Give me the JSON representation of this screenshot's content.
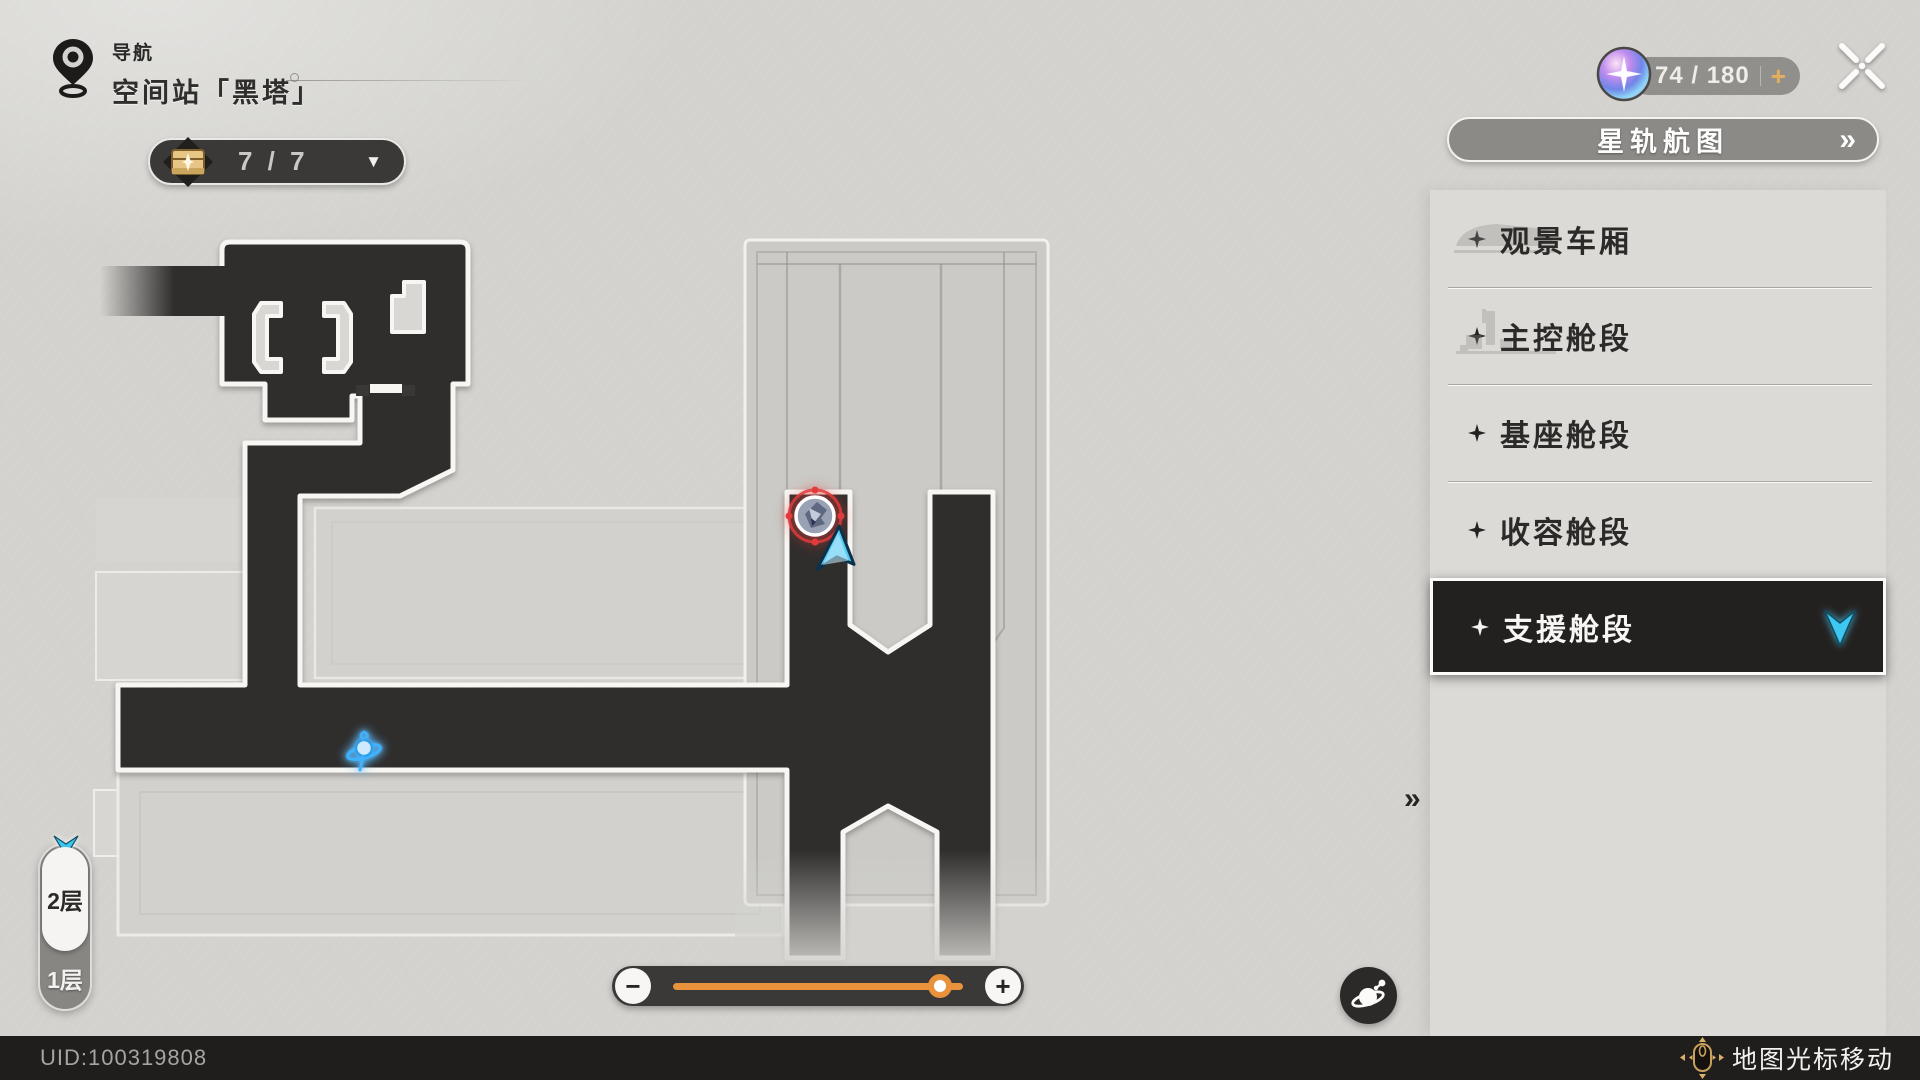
{
  "header": {
    "nav_label": "导航",
    "location": "空间站「黑塔」"
  },
  "chest": {
    "count": "7 / 7",
    "dropdown_glyph": "▼"
  },
  "stamina": {
    "value": "74 / 180",
    "add_label": "+"
  },
  "chart_button": {
    "label": "星轨航图",
    "chevron": "»"
  },
  "sidebar": {
    "items": [
      {
        "label": "观景车厢",
        "selected": false
      },
      {
        "label": "主控舱段",
        "selected": false
      },
      {
        "label": "基座舱段",
        "selected": false
      },
      {
        "label": "收容舱段",
        "selected": false
      },
      {
        "label": "支援舱段",
        "selected": true
      }
    ],
    "selected_pointer_glyph": "»"
  },
  "floors": {
    "upper": "2层",
    "lower": "1层",
    "selected": "2层"
  },
  "zoom_control": {
    "minus": "−",
    "plus": "+",
    "value_pct": 92
  },
  "footer": {
    "uid": "UID:100319808",
    "hint": "地图光标移动"
  },
  "icons": {
    "nav_pin": "map-pin",
    "chest": "treasure-chest",
    "stamina_orb": "trailblaze-power-orb",
    "close": "stylized-x",
    "floor_arrow": "cyan-chevron-down",
    "selected_arrow": "cyan-chevron-down",
    "planet": "planet-with-ring",
    "mouse": "mouse-with-arrows",
    "map_marker": "enemy-teleport-marker",
    "map_cursor": "cyan-pointer",
    "anchor": "space-anchor-gyro"
  },
  "colors": {
    "map_dark": "#302e2d",
    "background": "#d3d2ce",
    "panel": "#dbdad6",
    "accent_orange": "#e8923c",
    "cyan": "#3ec7f1",
    "gold": "#d8ab60",
    "marker_red": "#e23b3b",
    "bar_dark": "#201e1d"
  }
}
